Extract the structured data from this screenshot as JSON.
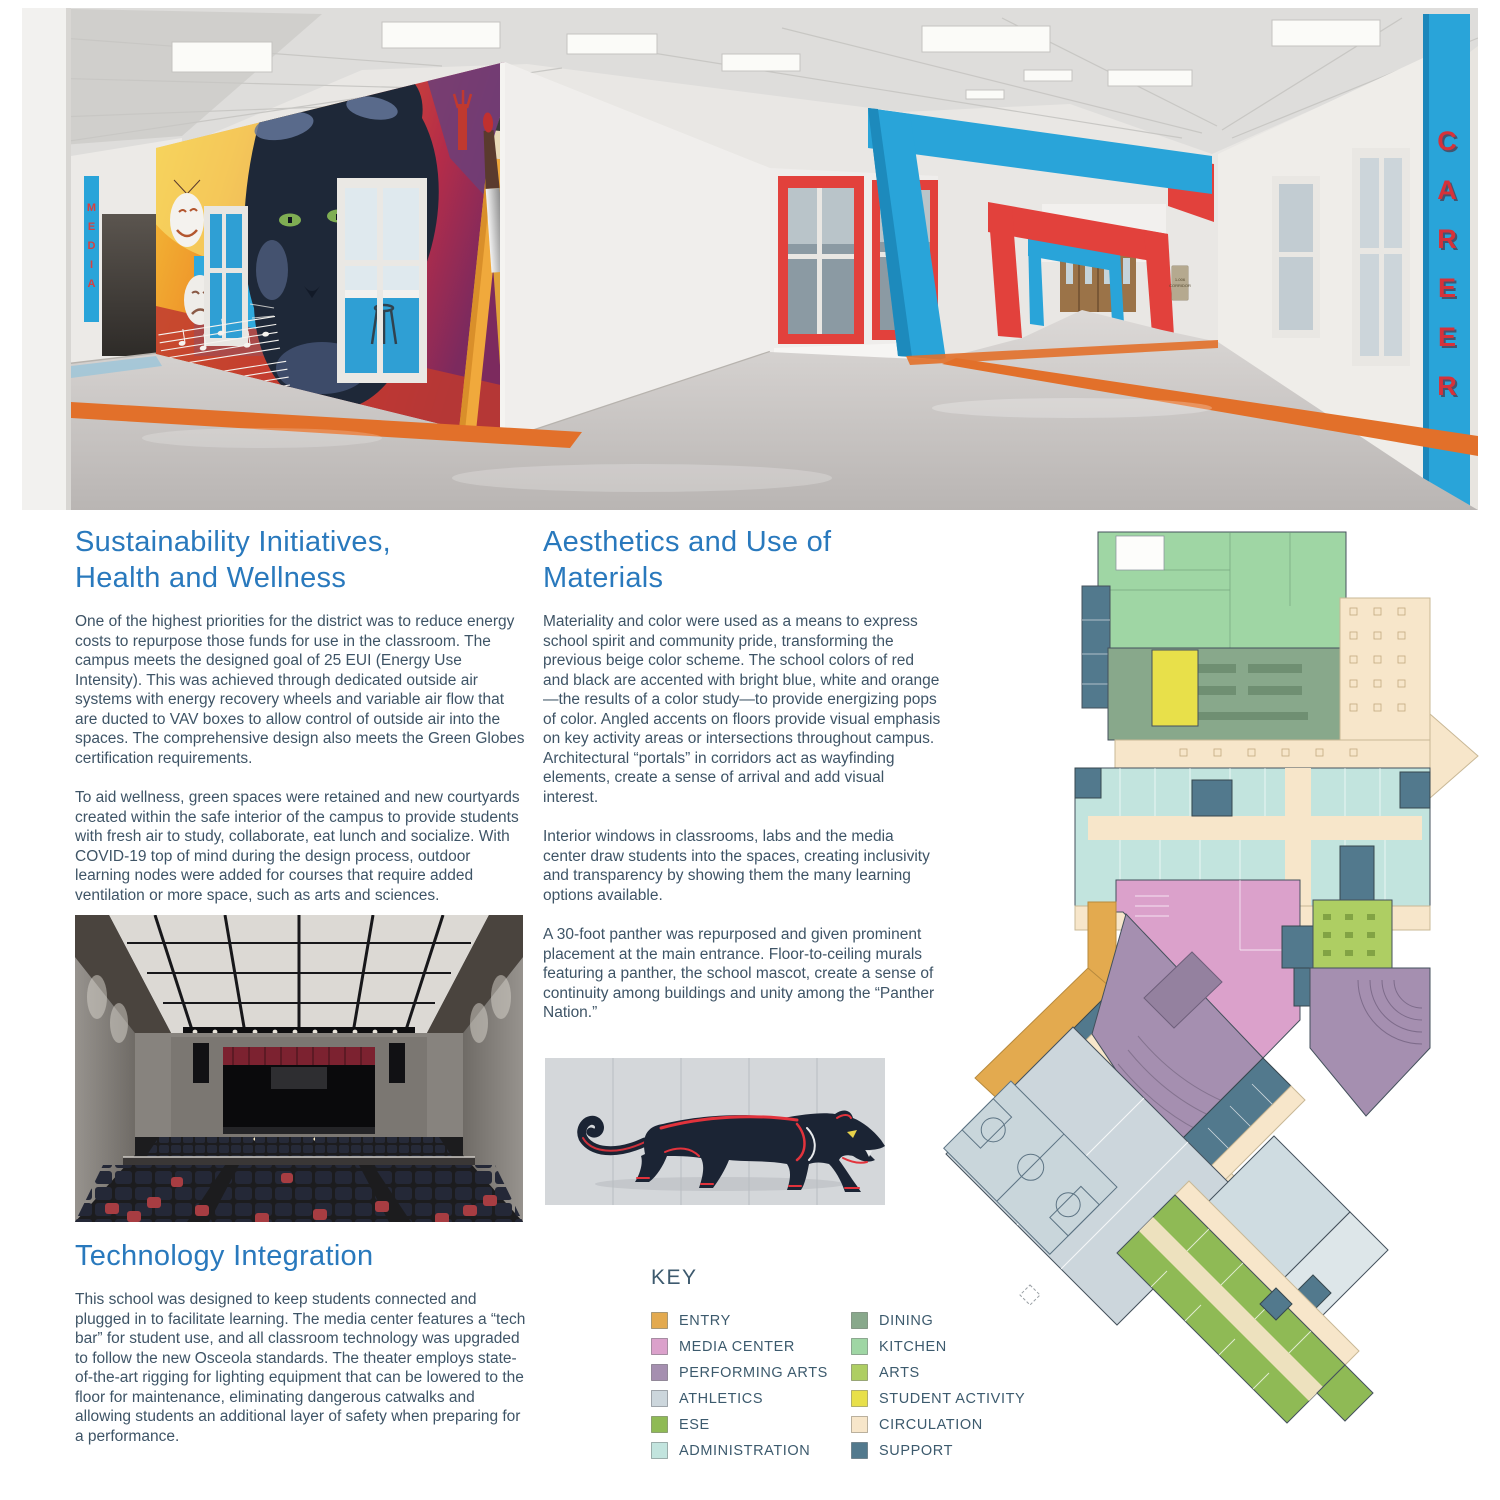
{
  "hero": {
    "media_sign": "MEDIA",
    "career_sign": "CAREER",
    "room_sign_line1": "1-006",
    "room_sign_line2": "CORRIDOR",
    "colors": {
      "blue": "#29a4d9",
      "red": "#e2413c",
      "orange": "#e2702a"
    }
  },
  "sections": {
    "sustainability": {
      "title": "Sustainability Initiatives,\nHealth and Wellness",
      "para1": "One of the highest priorities for the district was to reduce energy costs to repurpose those funds for use in the classroom. The campus meets the designed goal of 25 EUI (Energy Use Intensity). This was achieved through dedicated outside air systems with energy recovery wheels and variable air flow that are ducted to VAV boxes to allow control of outside air into the spaces. The comprehensive design also meets the Green Globes certification requirements.",
      "para2": "To aid wellness, green spaces were retained and new courtyards created within the safe interior of the campus to provide students with fresh air to study, collaborate, eat lunch and socialize. With COVID-19 top of mind during the design process, outdoor learning nodes were added for courses that require added ventilation or more space, such as arts and sciences."
    },
    "aesthetics": {
      "title": "Aesthetics and Use of\nMaterials",
      "para1": "Materiality and color were used as a means to express school spirit and community pride, transforming the previous beige color scheme. The school colors of red and black are accented with bright blue, white and orange—the results of a color study—to provide energizing pops of color. Angled accents on floors provide visual emphasis on key activity areas or intersections throughout campus. Architectural “portals” in corridors act as wayfinding elements, create a sense of arrival and add visual interest.",
      "para2": "Interior windows in classrooms, labs and the media center draw students into the spaces, creating inclusivity and transparency by showing them the many learning options available.",
      "para3": "A 30-foot panther was repurposed and given prominent placement at the main entrance. Floor-to-ceiling murals featuring a panther, the school mascot, create a sense of continuity among buildings and unity among the “Panther Nation.”"
    },
    "technology": {
      "title": "Technology Integration",
      "para1": "This school was designed to keep students connected and plugged in to facilitate learning. The media center features a “tech bar” for student use, and all classroom technology was upgraded to follow the new Osceola standards. The theater employs state-of-the-art rigging for lighting equipment that can be lowered to the floor for maintenance, eliminating dangerous catwalks and allowing students an additional layer of safety when preparing for a performance."
    }
  },
  "key": {
    "title": "KEY",
    "items": [
      {
        "label": "ENTRY",
        "color": "#e3aa4f"
      },
      {
        "label": "MEDIA CENTER",
        "color": "#dba1cb"
      },
      {
        "label": "PERFORMING ARTS",
        "color": "#a58fb0"
      },
      {
        "label": "ATHLETICS",
        "color": "#ccd6dc"
      },
      {
        "label": "ESE",
        "color": "#8fba55"
      },
      {
        "label": "ADMINISTRATION",
        "color": "#c2e4de"
      },
      {
        "label": "DINING",
        "color": "#88a88b"
      },
      {
        "label": "KITCHEN",
        "color": "#9fd6a4"
      },
      {
        "label": "ARTS",
        "color": "#aece63"
      },
      {
        "label": "STUDENT ACTIVITY",
        "color": "#e8e04a"
      },
      {
        "label": "CIRCULATION",
        "color": "#f7e6ca"
      },
      {
        "label": "SUPPORT",
        "color": "#52798d"
      }
    ]
  },
  "plan": {
    "colors": {
      "entry": "#e3aa4f",
      "media_center": "#dba1cb",
      "performing_arts": "#a58fb0",
      "athletics": "#ccd6dc",
      "ese": "#8fba55",
      "administration": "#c2e4de",
      "dining": "#88a88b",
      "kitchen": "#9fd6a4",
      "arts": "#aece63",
      "student_activity": "#e8e04a",
      "circulation": "#f7e6ca",
      "support": "#52798d"
    }
  }
}
